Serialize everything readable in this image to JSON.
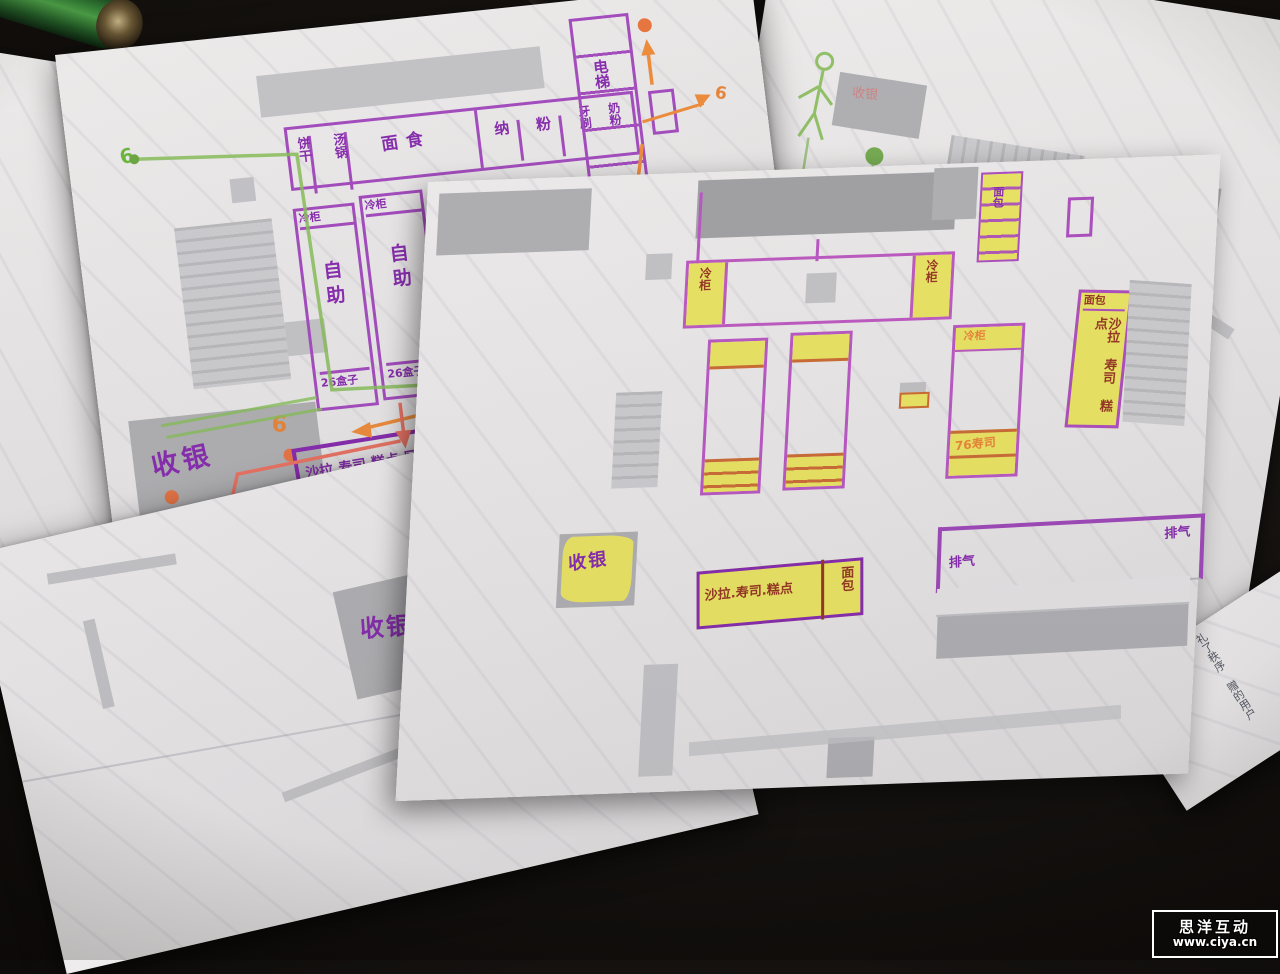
{
  "watermark": {
    "title": "思洋互动",
    "url": "www.ciya.cn"
  },
  "battery": {
    "brand": "MAX"
  },
  "left_paper": {
    "dept_row": [
      "饼干",
      "汤锅",
      "面食",
      "纳",
      "粉",
      "牙刷",
      "奶粉"
    ],
    "escalator_label": "电梯",
    "shelf1_cap": "冷柜",
    "shelf1_body": "自助",
    "shelf1_foot": "26盒子",
    "shelf2_cap": "冷柜",
    "shelf2_body": "自助",
    "shelf2_foot": "26盒子",
    "cashier_label": "收银",
    "cashier_number": "6",
    "green_number": "6",
    "route_number": "6",
    "salad_zone_label": "沙拉.寿司.糕点.区"
  },
  "main_paper": {
    "cold_cabinet_left": "冷柜",
    "cold_cabinet_right": "冷柜",
    "right_shelf_cap": "冷柜",
    "right_shelf_foot": "76寿司",
    "food_strip_top": "面包",
    "food_strip_body": "沙拉 寿司 糕点",
    "stair_strip_label": "面包",
    "cashier_label": "收银",
    "salad_box_label": "沙拉.寿司.糕点",
    "salad_box_side": "面包",
    "vent_left": "排气",
    "vent_right": "排气"
  },
  "bottom_paper": {
    "cashier_label": "收银"
  },
  "back_paper": {
    "faint_label": "收银"
  },
  "side_paper": {
    "pen_note": "礼了秩序 赠的用户"
  }
}
